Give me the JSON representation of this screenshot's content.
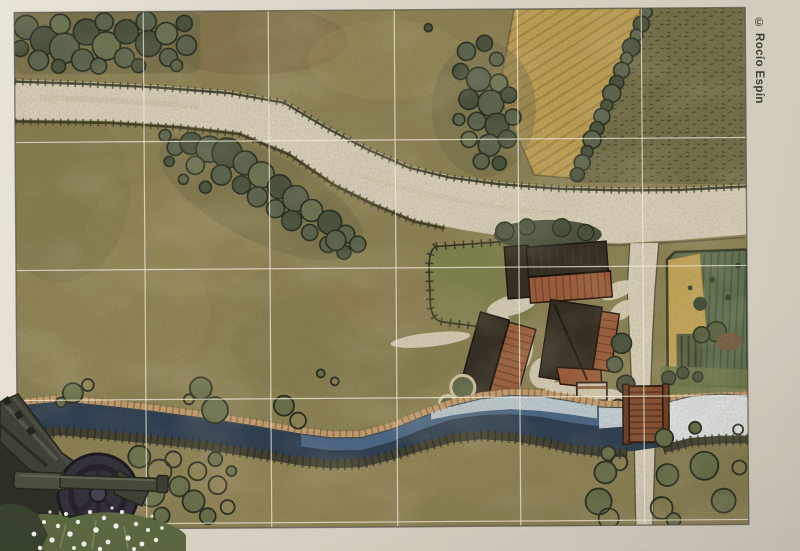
{
  "credit": {
    "text": "© Rocío Espín"
  },
  "map": {
    "grid": {
      "columns": 6,
      "rows": 5
    },
    "features": [
      "woodland",
      "diagonal-hedgerow",
      "country-road",
      "side-road",
      "farmstead",
      "fenced-paddock",
      "plowed-field",
      "crop-field",
      "scrub-field",
      "river",
      "wooden-bridge",
      "shrubs",
      "riverbank",
      "grid-overlay"
    ]
  },
  "photo_inset": {
    "subject": "field-artillery-gun",
    "foreground": "white-wildflowers"
  },
  "colors": {
    "grass": "#8e8355",
    "road": "#ded5bf",
    "tree": "#5c654e",
    "treeOutline": "#232a1d",
    "scrub": "#74704a",
    "plow": "#c3a254",
    "paddock": "#7f834c",
    "roofDark": "#312a20",
    "roofRed": "#9d5c3a",
    "cropGreen": "#5f7151",
    "cropYellow": "#c9a958",
    "riverDark": "#2b3d52",
    "riverPale": "#e7edef",
    "bankSand": "#c9a171",
    "bankDark": "#3f3e30",
    "bridge": "#8a5132",
    "gridLine": "#f1ecdd",
    "gunMetal": "#3f4036",
    "flower": "#f2f3ea",
    "ink": "#3f3e38"
  }
}
